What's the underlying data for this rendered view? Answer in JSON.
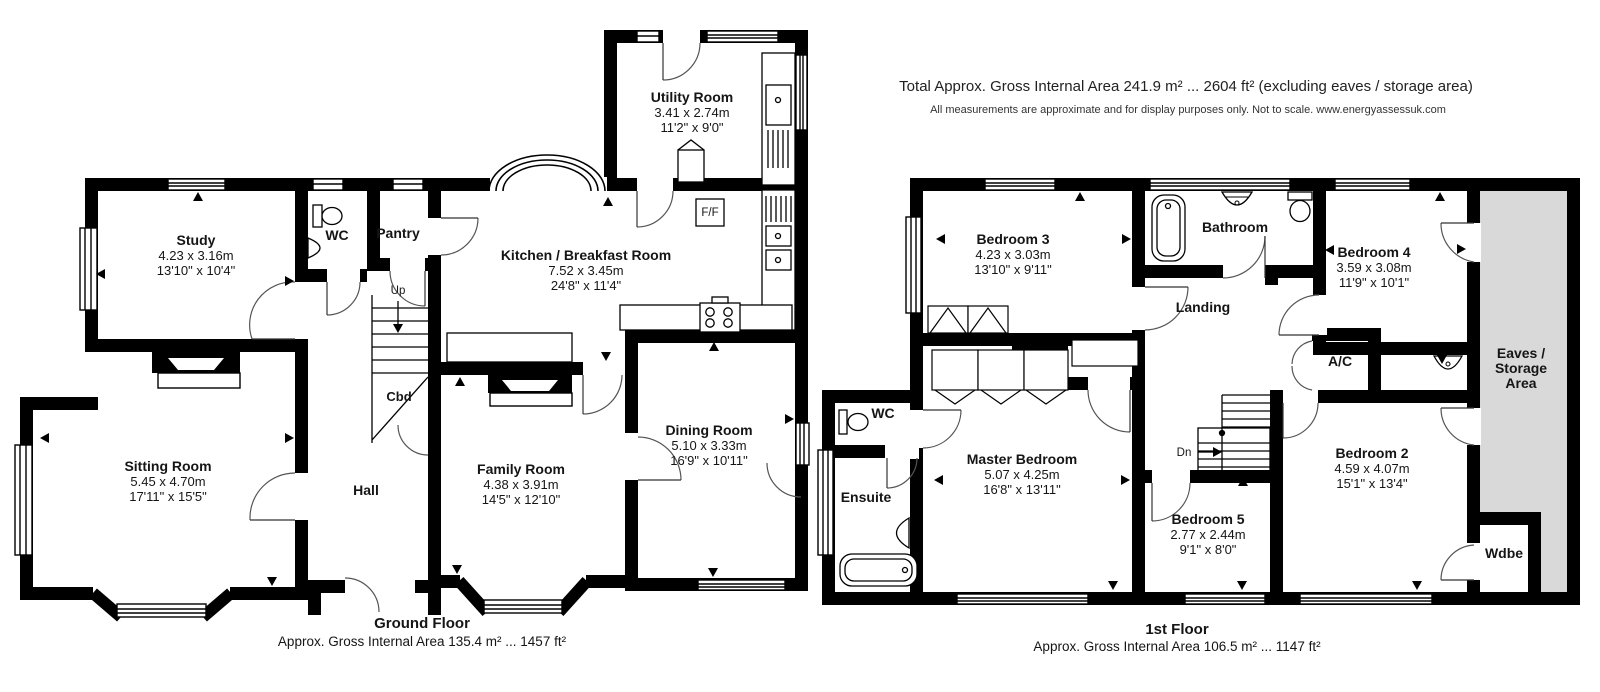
{
  "header": {
    "title": "Total Approx. Gross Internal Area 241.9 m² ... 2604 ft² (excluding eaves / storage area)",
    "disclaimer": "All measurements are approximate and for display purposes only. Not to scale. www.energyassessuk.com"
  },
  "ground_floor": {
    "title": "Ground Floor",
    "area": "Approx. Gross Internal Area 135.4 m² ... 1457 ft²",
    "rooms": [
      {
        "name": "Study",
        "metric": "4.23 x 3.16m",
        "imperial": "13'10\" x 10'4\""
      },
      {
        "name": "WC"
      },
      {
        "name": "Pantry"
      },
      {
        "name": "Utility Room",
        "metric": "3.41 x 2.74m",
        "imperial": "11'2\" x 9'0\""
      },
      {
        "name": "Kitchen / Breakfast Room",
        "metric": "7.52 x 3.45m",
        "imperial": "24'8\" x 11'4\""
      },
      {
        "name": "Sitting Room",
        "metric": "5.45 x 4.70m",
        "imperial": "17'11\" x 15'5\""
      },
      {
        "name": "Hall"
      },
      {
        "name": "Family Room",
        "metric": "4.38 x 3.91m",
        "imperial": "14'5\" x 12'10\""
      },
      {
        "name": "Dining Room",
        "metric": "5.10 x 3.33m",
        "imperial": "16'9\" x 10'11\""
      }
    ],
    "annotations": {
      "up": "Up",
      "cbd": "Cbd",
      "ff": "F/F"
    }
  },
  "first_floor": {
    "title": "1st Floor",
    "area": "Approx. Gross Internal Area 106.5 m² ... 1147 ft²",
    "rooms": [
      {
        "name": "Bedroom 3",
        "metric": "4.23 x 3.03m",
        "imperial": "13'10\" x 9'11\""
      },
      {
        "name": "Bathroom"
      },
      {
        "name": "Bedroom 4",
        "metric": "3.59 x 3.08m",
        "imperial": "11'9\" x 10'1\""
      },
      {
        "name": "Landing"
      },
      {
        "name": "A/C"
      },
      {
        "name": "Eaves / Storage Area",
        "lines": [
          "Eaves /",
          "Storage",
          "Area"
        ]
      },
      {
        "name": "WC"
      },
      {
        "name": "Master Bedroom",
        "metric": "5.07 x 4.25m",
        "imperial": "16'8\" x 13'11\""
      },
      {
        "name": "Ensuite"
      },
      {
        "name": "Bedroom 5",
        "metric": "2.77 x 2.44m",
        "imperial": "9'1\" x 8'0\""
      },
      {
        "name": "Bedroom 2",
        "metric": "4.59 x 4.07m",
        "imperial": "15'1\" x 13'4\""
      },
      {
        "name": "Wdbe"
      }
    ],
    "annotations": {
      "dn": "Dn"
    }
  }
}
